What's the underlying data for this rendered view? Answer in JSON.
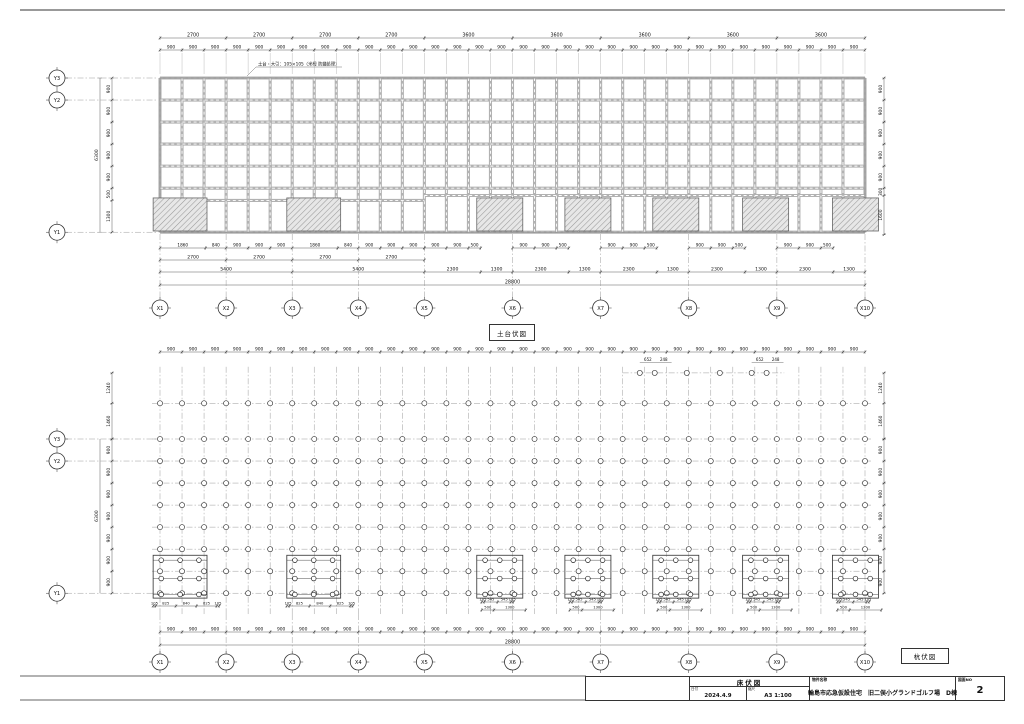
{
  "sheet": {
    "labels": {
      "sill_plan": "土台伏図",
      "pile_plan": "杭伏図"
    },
    "note_sill": "土台・大引：105×105（米栂 防蟻処理）",
    "title_block": {
      "drawing_title": "床伏図",
      "date_label": "日付",
      "date": "2024.4.9",
      "scale_label": "縮尺",
      "scale": "A3 1:100",
      "project_label": "物件名称",
      "project_name": "輪島市応急仮設住宅　旧二俣小グランドゴルフ場　D棟",
      "sheet_no_label": "図面NO",
      "sheet_no": "2"
    }
  },
  "axes": {
    "x": [
      "X1",
      "X2",
      "X3",
      "X4",
      "X5",
      "X6",
      "X7",
      "X8",
      "X9",
      "X10"
    ],
    "x_mm": [
      0,
      2700,
      5400,
      8100,
      10800,
      14400,
      18000,
      21600,
      25200,
      28800
    ],
    "y": [
      "Y3",
      "Y2",
      "Y1"
    ]
  },
  "sill": {
    "top_major": [
      2700,
      2700,
      2700,
      2700,
      3600,
      3600,
      3600,
      3600,
      3600
    ],
    "minor_label": "900",
    "left_chain": [
      900,
      900,
      900,
      900,
      900,
      500,
      1300
    ],
    "left_total": "6300",
    "right_chain": [
      900,
      900,
      900,
      900,
      900,
      300,
      1600
    ],
    "rows_mm": [
      0,
      900,
      1800,
      2700,
      3600,
      4500,
      6300
    ],
    "partial_rows": [
      {
        "mm": 5000,
        "from": 0,
        "to": 10800
      },
      {
        "mm": 4800,
        "from": 10800,
        "to": 28800
      }
    ],
    "bottom_fine": [
      1860,
      840,
      900,
      900,
      900,
      1860,
      840,
      900,
      900,
      900
    ],
    "bottom_fine_groups_at": [
      10800,
      14400,
      18000,
      21600,
      25200
    ],
    "bottom_fine_group": [
      900,
      900,
      500
    ],
    "bottom_mid": [
      2700,
      2700,
      2700,
      2700
    ],
    "bottom_major": [
      5400,
      5400,
      2300,
      1300,
      2300,
      1300,
      2300,
      1300,
      2300,
      1300,
      2300,
      1300
    ],
    "total": "28800",
    "pedestals_mm": [
      {
        "x": -280,
        "w": 2200
      },
      {
        "x": 5180,
        "w": 2200
      },
      {
        "x": 12940,
        "w": 1880
      },
      {
        "x": 16540,
        "w": 1880
      },
      {
        "x": 20130,
        "w": 1880
      },
      {
        "x": 23800,
        "w": 1880
      },
      {
        "x": 27470,
        "w": 1880
      }
    ],
    "pedestal_y": {
      "y": 4900,
      "h": 1350
    }
  },
  "pile": {
    "minor_label": "900",
    "rows_mm": [
      -1460,
      0,
      900,
      1800,
      2700,
      3600,
      4500,
      5400,
      6300
    ],
    "sparse_row_mm": -2700,
    "sparse_x_mm": [
      19600,
      20210,
      21520,
      22870,
      24170,
      24780
    ],
    "sparse_dims": [
      "652",
      "248"
    ],
    "left_chain_top": [
      1240,
      1460
    ],
    "left_chain": [
      900,
      900,
      900,
      900,
      900,
      900,
      900
    ],
    "left_total": "6300",
    "clusters_mm": [
      {
        "x": -280,
        "w": 2200,
        "wide": true
      },
      {
        "x": 5180,
        "w": 2200,
        "wide": true
      },
      {
        "x": 12940,
        "w": 1880,
        "wide": false
      },
      {
        "x": 16540,
        "w": 1880,
        "wide": false
      },
      {
        "x": 20130,
        "w": 1880,
        "wide": false
      },
      {
        "x": 23800,
        "w": 1880,
        "wide": false
      },
      {
        "x": 27470,
        "w": 1880,
        "wide": false
      }
    ],
    "cluster_dims_wide": [
      105,
      825,
      840,
      825,
      105
    ],
    "cluster_dims_narrow_1": [
      105,
      545,
      545,
      105
    ],
    "cluster_dims_narrow_2": [
      500,
      1300
    ],
    "total": "28800"
  },
  "geometry": {
    "scale_px_per_mm": 0.0244792,
    "x_origin_px": 160,
    "sill_top_px": 78,
    "pile_y3_px": 439,
    "module_mm": 900,
    "modules_x": 32,
    "total_mm": 28800
  },
  "colors": {
    "beam_gray": "#b2b2b2",
    "beam_edge": "#8f8f8f",
    "thin_line": "#333333",
    "grid_dash": "#909090",
    "hatch": "#9a9a9a",
    "hatch_bg": "#e7e7e7"
  }
}
